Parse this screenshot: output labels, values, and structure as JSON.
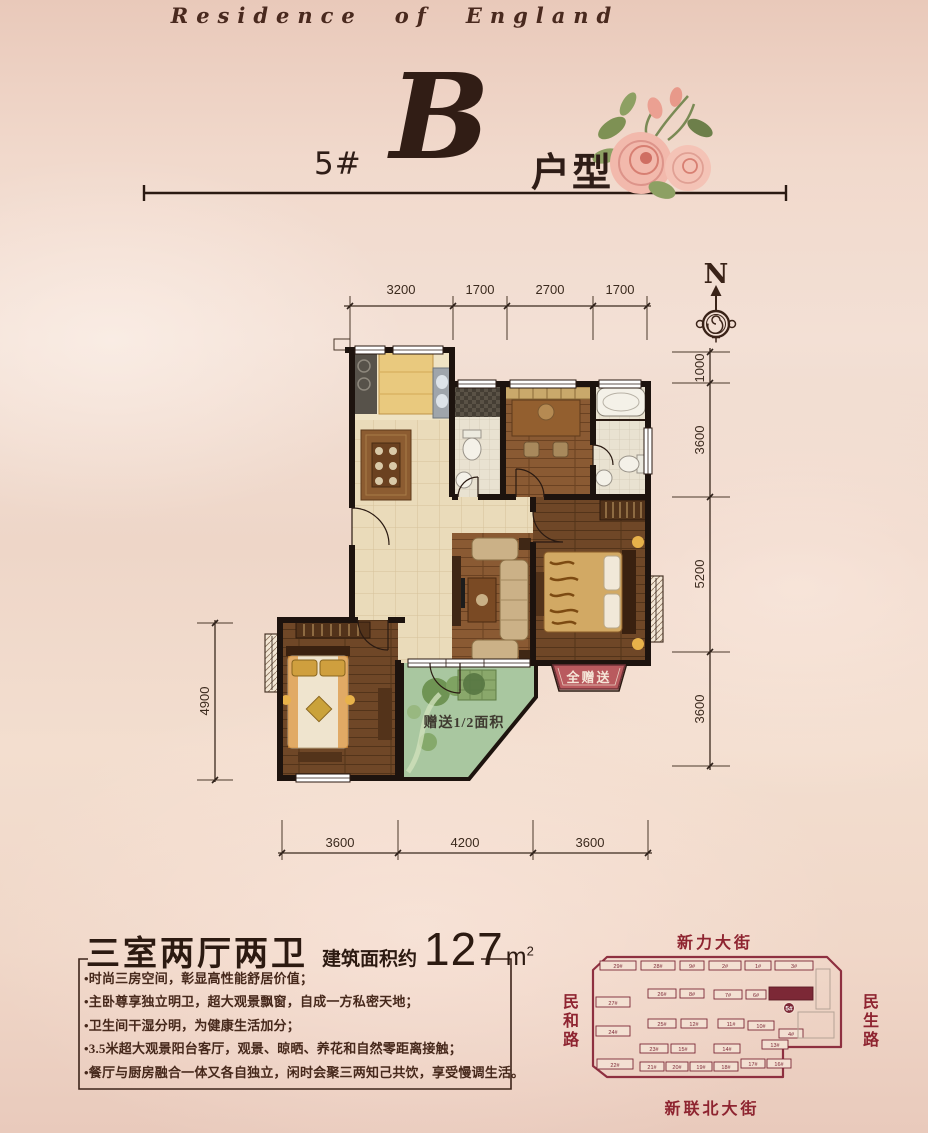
{
  "header": {
    "brand": "Residence of England",
    "block_number": "5#",
    "type_letter": "B",
    "type_label": "户型"
  },
  "compass": {
    "north": "N"
  },
  "plan": {
    "dims_top": [
      "3200",
      "1700",
      "2700",
      "1700"
    ],
    "dims_right": [
      "1000",
      "3600",
      "5200",
      "3600"
    ],
    "dims_bottom": [
      "3600",
      "4200",
      "3600"
    ],
    "dim_left": "4900",
    "balcony_note": "赠送1/2面积",
    "gift_ribbon": "全赠送"
  },
  "summary": {
    "title": "三室两厅两卫",
    "area_prefix": "建筑面积约",
    "area_value": "127",
    "area_unit_base": "m",
    "area_unit_sup": "2",
    "bullets": [
      "•时尚三房空间，彰显高性能舒居价值；",
      "•主卧尊享独立明卫，超大观景飘窗，自成一方私密天地；",
      "•卫生间干湿分明，为健康生活加分；",
      "•3.5米超大观景阳台客厅，观景、晾晒、养花和自然零距离接触；",
      "•餐厅与厨房融合一体又各自独立，闲时会聚三两知己共饮，享受慢调生活。"
    ]
  },
  "site_map": {
    "street_top": "新力大街",
    "street_left": "民和路",
    "street_right": "民生路",
    "street_bottom": "新联北大街",
    "highlight_label": "5#",
    "buildings": [
      {
        "label": "29#",
        "x": 600,
        "y": 961,
        "w": 36,
        "h": 9,
        "t": "n"
      },
      {
        "label": "28#",
        "x": 641,
        "y": 961,
        "w": 34,
        "h": 9,
        "t": "n"
      },
      {
        "label": "9#",
        "x": 680,
        "y": 961,
        "w": 24,
        "h": 9,
        "t": "n"
      },
      {
        "label": "2#",
        "x": 709,
        "y": 961,
        "w": 32,
        "h": 9,
        "t": "n"
      },
      {
        "label": "1#",
        "x": 745,
        "y": 961,
        "w": 26,
        "h": 9,
        "t": "n"
      },
      {
        "label": "3#",
        "x": 775,
        "y": 961,
        "w": 38,
        "h": 9,
        "t": "n"
      },
      {
        "label": "27#",
        "x": 596,
        "y": 997,
        "w": 34,
        "h": 10,
        "t": "n"
      },
      {
        "label": "26#",
        "x": 648,
        "y": 989,
        "w": 28,
        "h": 9,
        "t": "n"
      },
      {
        "label": "8#",
        "x": 680,
        "y": 989,
        "w": 24,
        "h": 9,
        "t": "n"
      },
      {
        "label": "7#",
        "x": 714,
        "y": 990,
        "w": 28,
        "h": 9,
        "t": "n"
      },
      {
        "label": "6#",
        "x": 746,
        "y": 990,
        "w": 20,
        "h": 9,
        "t": "n"
      },
      {
        "label": "5#",
        "x": 769,
        "y": 987,
        "w": 44,
        "h": 13,
        "t": "h"
      },
      {
        "label": "24#",
        "x": 596,
        "y": 1026,
        "w": 34,
        "h": 10,
        "t": "n"
      },
      {
        "label": "25#",
        "x": 648,
        "y": 1019,
        "w": 28,
        "h": 9,
        "t": "n"
      },
      {
        "label": "12#",
        "x": 681,
        "y": 1019,
        "w": 26,
        "h": 9,
        "t": "n"
      },
      {
        "label": "11#",
        "x": 718,
        "y": 1019,
        "w": 26,
        "h": 9,
        "t": "n"
      },
      {
        "label": "10#",
        "x": 748,
        "y": 1021,
        "w": 26,
        "h": 9,
        "t": "n"
      },
      {
        "label": "4#",
        "x": 779,
        "y": 1029,
        "w": 24,
        "h": 9,
        "t": "n"
      },
      {
        "label": "23#",
        "x": 640,
        "y": 1044,
        "w": 28,
        "h": 9,
        "t": "n"
      },
      {
        "label": "15#",
        "x": 671,
        "y": 1044,
        "w": 24,
        "h": 9,
        "t": "n"
      },
      {
        "label": "14#",
        "x": 714,
        "y": 1044,
        "w": 26,
        "h": 9,
        "t": "n"
      },
      {
        "label": "13#",
        "x": 762,
        "y": 1040,
        "w": 26,
        "h": 9,
        "t": "n"
      },
      {
        "label": "22#",
        "x": 597,
        "y": 1059,
        "w": 36,
        "h": 10,
        "t": "n"
      },
      {
        "label": "21#",
        "x": 640,
        "y": 1062,
        "w": 24,
        "h": 9,
        "t": "n"
      },
      {
        "label": "20#",
        "x": 666,
        "y": 1062,
        "w": 22,
        "h": 9,
        "t": "n"
      },
      {
        "label": "19#",
        "x": 690,
        "y": 1062,
        "w": 22,
        "h": 9,
        "t": "n"
      },
      {
        "label": "18#",
        "x": 714,
        "y": 1062,
        "w": 24,
        "h": 9,
        "t": "n"
      },
      {
        "label": "17#",
        "x": 741,
        "y": 1059,
        "w": 24,
        "h": 9,
        "t": "n"
      },
      {
        "label": "16#",
        "x": 767,
        "y": 1059,
        "w": 24,
        "h": 9,
        "t": "n"
      },
      {
        "label": "",
        "x": 816,
        "y": 969,
        "w": 14,
        "h": 40,
        "t": "g"
      },
      {
        "label": "",
        "x": 798,
        "y": 1012,
        "w": 36,
        "h": 26,
        "t": "g"
      }
    ]
  },
  "colors": {
    "accent_red": "#8e2430",
    "ribbon_red": "#b95a5e",
    "ink": "#3a241c",
    "wall": "#1d130e",
    "balcony_green": "#a9c7a0"
  }
}
